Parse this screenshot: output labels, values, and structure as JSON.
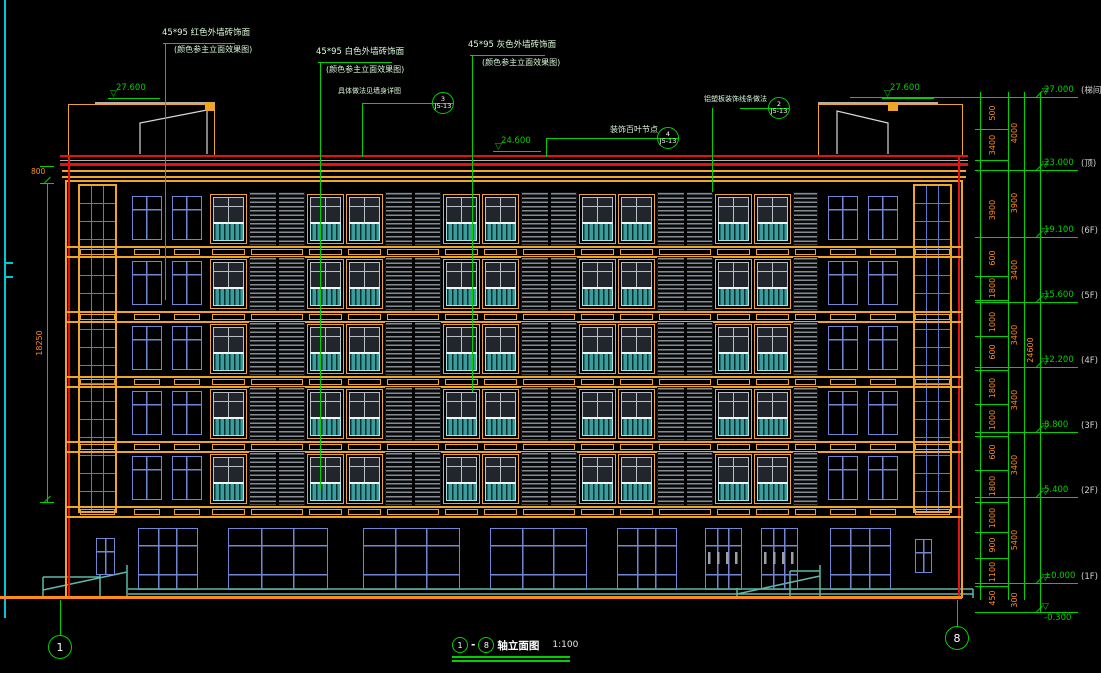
{
  "drawing_title": {
    "axis_start": "1",
    "axis_end": "8",
    "label": "轴立面图",
    "scale": "1:100"
  },
  "annotations": {
    "red_tile": "45*95  红色外墙砖饰面",
    "white_tile": "45*95  白色外墙砖饰面",
    "gray_tile": "45*95  灰色外墙砖饰面",
    "color_note": "(颜色参主立面效果图)",
    "wall_detail_note": "具体做法见墙身详图",
    "louver_note": "装饰百叶节点",
    "alum_note": "铝塑板装饰线条做法"
  },
  "detail_bubbles": [
    {
      "num": "3",
      "ref": "J5-13"
    },
    {
      "num": "4",
      "ref": "J5-13"
    },
    {
      "num": "2",
      "ref": "J5-13"
    }
  ],
  "elevations": {
    "left_parapet": "27.600",
    "mid_parapet": "24.600",
    "right_parapet": "27.600",
    "right_stack": [
      {
        "value": "27.000",
        "label": "(梯间顶)"
      },
      {
        "value": "23.000",
        "label": "(顶)"
      },
      {
        "value": "19.100",
        "label": "(6F)"
      },
      {
        "value": "15.600",
        "label": "(5F)"
      },
      {
        "value": "12.200",
        "label": "(4F)"
      },
      {
        "value": "8.800",
        "label": "(3F)"
      },
      {
        "value": "5.400",
        "label": "(2F)"
      },
      {
        "value": "±0.000",
        "label": "(1F)"
      },
      {
        "value": "-0.300",
        "label": ""
      }
    ]
  },
  "dimensions": {
    "left_top": "800",
    "left_total": "18250",
    "col_a": [
      "500",
      "3400",
      "3900",
      "600",
      "1800",
      "1000",
      "600",
      "1800",
      "1000",
      "600",
      "1800",
      "1000",
      "900",
      "1100",
      "450"
    ],
    "col_b": [
      "4000",
      "3900",
      "3400",
      "3400",
      "3400",
      "3400",
      "5400",
      "300"
    ],
    "col_c": [
      "24600"
    ]
  },
  "axis_bubbles": [
    "1",
    "8"
  ],
  "colors": {
    "cad_green": "#00d200",
    "cad_red": "#e81010",
    "frame_yellow": "#eda62a",
    "dim_orange": "#ff8c1a",
    "panel_gray": "#8a8f94",
    "rail_teal": "#3a9c9c",
    "window_blue": "#7287d4",
    "ramp_teal": "#5fb8a8",
    "frame_cyan": "#00c8d8"
  }
}
